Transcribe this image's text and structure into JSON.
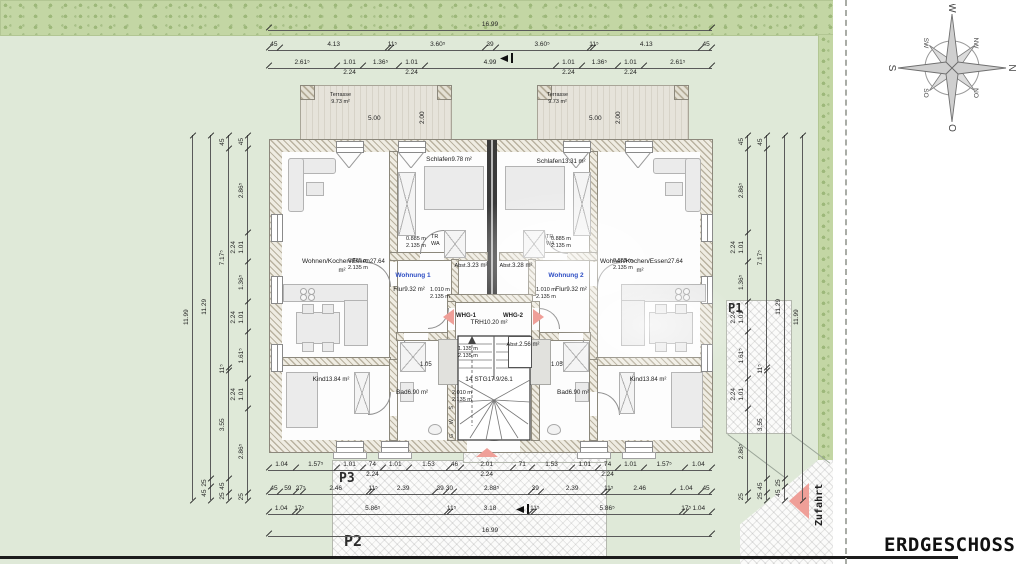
{
  "sheet": {
    "title": "ERDGESCHOSS"
  },
  "compass": {
    "n": "N",
    "no": "NO",
    "o": "O",
    "so": "SO",
    "s": "S",
    "sw": "SW",
    "w": "W",
    "nw": "NW"
  },
  "site": {
    "zufahrt": "Zufahrt",
    "p1": "P1",
    "p2": "P2",
    "p3": "P3"
  },
  "terrace": {
    "name": "Terrasse",
    "area": "9.73 m²",
    "w": "5.00",
    "d": "2.00"
  },
  "apt_left": {
    "wohnung": "Wohnung 1",
    "wohnen": "Wohnen/Kochen/Essen",
    "wohnen_area": "27.64 m²",
    "schlafen": "Schlafen",
    "schlafen_area": "9.78 m²",
    "kind": "Kind",
    "kind_area": "13.84 m²",
    "bad": "Bad",
    "bad_area": "6.90 m²",
    "flur": "Flur",
    "flur_area": "9.32 m²",
    "abst": "Abst.",
    "abst_area": "3.23 m²",
    "tr": "TR",
    "wa": "WA"
  },
  "apt_right": {
    "wohnung": "Wohnung 2",
    "wohnen": "Wohnen/Kochen/Essen",
    "wohnen_area": "27.64 m²",
    "schlafen": "Schlafen",
    "schlafen_area": "13.31 m²",
    "kind": "Kind",
    "kind_area": "13.84 m²",
    "bad": "Bad",
    "bad_area": "6.90 m²",
    "flur": "Flur",
    "flur_area": "9.32 m²",
    "abst": "Abst.",
    "abst_area": "3.28 m²",
    "tr": "TR",
    "wa": "WA"
  },
  "core": {
    "whg1": "WHG-1",
    "whg2": "WHG-2",
    "trh": "TRH",
    "trh_area": "10.20 m²",
    "stg": "14 STG",
    "stg_spec": "17.9/26.1",
    "abst": "Abst.",
    "abst_area": "2.56 m²",
    "gws": "G W S",
    "dim105": "1.05",
    "dim120": "1.20"
  },
  "doors": {
    "w885": "0.885 m",
    "w1010": "1.010 m",
    "w1135": "1.135 m",
    "w2010": "2.010 m",
    "h": "2.135 m"
  },
  "chains": {
    "top1": [
      {
        "v": "16.99"
      }
    ],
    "top2": [
      "45",
      "4.13",
      "11⁵",
      "3.60⁵",
      "39",
      "3.60⁵",
      "11⁵",
      "4.13",
      "45"
    ],
    "top3": [
      "2.61⁵",
      {
        "v": "1.01",
        "sub": "2.24"
      },
      "1.36⁵",
      {
        "v": "1.01",
        "sub": "2.24"
      },
      "4.99",
      {
        "v": "1.01",
        "sub": "2.24"
      },
      "1.36⁵",
      {
        "v": "1.01",
        "sub": "2.24"
      },
      "2.61⁵"
    ],
    "bot1": [
      "1.04",
      "1.57⁵",
      "1.01",
      {
        "v": "74",
        "sub": "2.24"
      },
      "1.01",
      "1.53",
      "46",
      {
        "v": "2.01",
        "sub": "2.24"
      },
      "71",
      "1.53",
      "1.01",
      {
        "v": "74",
        "sub": "2.24"
      },
      "1.01",
      "1.57⁵",
      "1.04"
    ],
    "bot2": [
      "45",
      "59",
      "27⁵",
      "2.46",
      "11⁵",
      "2.39",
      "39",
      "30",
      "2.88⁵",
      "39",
      "2.39",
      "11⁵",
      "2.46",
      "1.04",
      "45"
    ],
    "bot3": [
      "1.04",
      "17⁵",
      "5.86⁵",
      "11⁵",
      "3.18",
      "11⁵",
      "5.86⁵",
      "17⁵",
      "1.04"
    ],
    "bot4": [
      {
        "v": "16.99"
      }
    ],
    "side1": [
      {
        "v": "11.99"
      }
    ],
    "side2": [
      "11.29",
      "25",
      "45"
    ],
    "side3": [
      "45",
      "7.17⁵",
      "11⁵",
      "3.55",
      "45",
      "25"
    ],
    "side4": [
      "45",
      "2.86⁵",
      {
        "v": "1.01",
        "sub": "2.24"
      },
      "1.36⁵",
      {
        "v": "1.01",
        "sub": "2.24"
      },
      "1.61⁵",
      {
        "v": "1.01",
        "sub": "2.24"
      },
      "2.86⁵",
      "25"
    ]
  }
}
